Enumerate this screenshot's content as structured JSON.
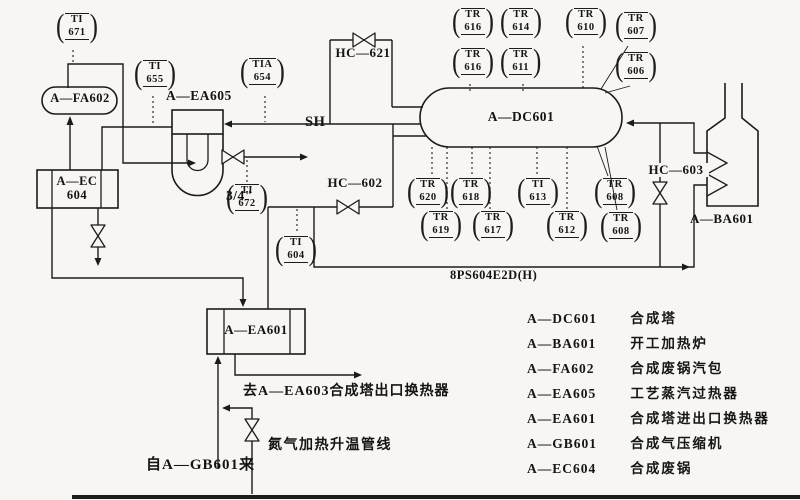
{
  "balloon": {
    "open": "(",
    "close": ")"
  },
  "instruments": [
    {
      "tag": "TI",
      "num": "671",
      "x": 56,
      "y": 13
    },
    {
      "tag": "TI",
      "num": "655",
      "x": 134,
      "y": 60
    },
    {
      "tag": "TIA",
      "num": "654",
      "x": 240,
      "y": 58
    },
    {
      "tag": "TI",
      "num": "672",
      "x": 226,
      "y": 184
    },
    {
      "tag": "TI",
      "num": "604",
      "x": 275,
      "y": 236
    },
    {
      "tag": "TR",
      "num": "616",
      "x": 452,
      "y": 8
    },
    {
      "tag": "TR",
      "num": "614",
      "x": 500,
      "y": 8
    },
    {
      "tag": "TR",
      "num": "610",
      "x": 565,
      "y": 8
    },
    {
      "tag": "TR",
      "num": "607",
      "x": 615,
      "y": 12
    },
    {
      "tag": "TR",
      "num": "616",
      "x": 452,
      "y": 48
    },
    {
      "tag": "TR",
      "num": "611",
      "x": 500,
      "y": 48
    },
    {
      "tag": "TR",
      "num": "606",
      "x": 615,
      "y": 52
    },
    {
      "tag": "TR",
      "num": "620",
      "x": 407,
      "y": 178
    },
    {
      "tag": "TR",
      "num": "618",
      "x": 450,
      "y": 178
    },
    {
      "tag": "TI",
      "num": "613",
      "x": 517,
      "y": 178
    },
    {
      "tag": "TR",
      "num": "608",
      "x": 594,
      "y": 178
    },
    {
      "tag": "TR",
      "num": "619",
      "x": 420,
      "y": 211
    },
    {
      "tag": "TR",
      "num": "617",
      "x": 472,
      "y": 211
    },
    {
      "tag": "TR",
      "num": "612",
      "x": 546,
      "y": 211
    },
    {
      "tag": "TR",
      "num": "608",
      "x": 600,
      "y": 212
    }
  ],
  "equipment": {
    "fa602": "A—FA602",
    "ec604_l1": "A—EC",
    "ec604_l2": "604",
    "ea605": "A—EA605",
    "dc601": "A—DC601",
    "ea601": "A—EA601",
    "ba601": "A—BA601"
  },
  "valves": {
    "hc621": "HC—621",
    "hc602": "HC—602",
    "hc603": "HC—603",
    "sh": "SH",
    "size": "3/4\""
  },
  "lines": {
    "header": "8PS604E2D(H)"
  },
  "notes": {
    "to_ea603": "去A—EA603合成塔出口换热器",
    "n2": "氮气加热升温管线",
    "from_gb601": "自A—GB601来"
  },
  "legend": [
    {
      "code": "A—DC601",
      "desc": "合成塔"
    },
    {
      "code": "A—BA601",
      "desc": "开工加热炉"
    },
    {
      "code": "A—FA602",
      "desc": "合成废锅汽包"
    },
    {
      "code": "A—EA605",
      "desc": "工艺蒸汽过热器"
    },
    {
      "code": "A—EA601",
      "desc": "合成塔进出口换热器"
    },
    {
      "code": "A—GB601",
      "desc": "合成气压缩机"
    },
    {
      "code": "A—EC604",
      "desc": "合成废锅"
    }
  ]
}
